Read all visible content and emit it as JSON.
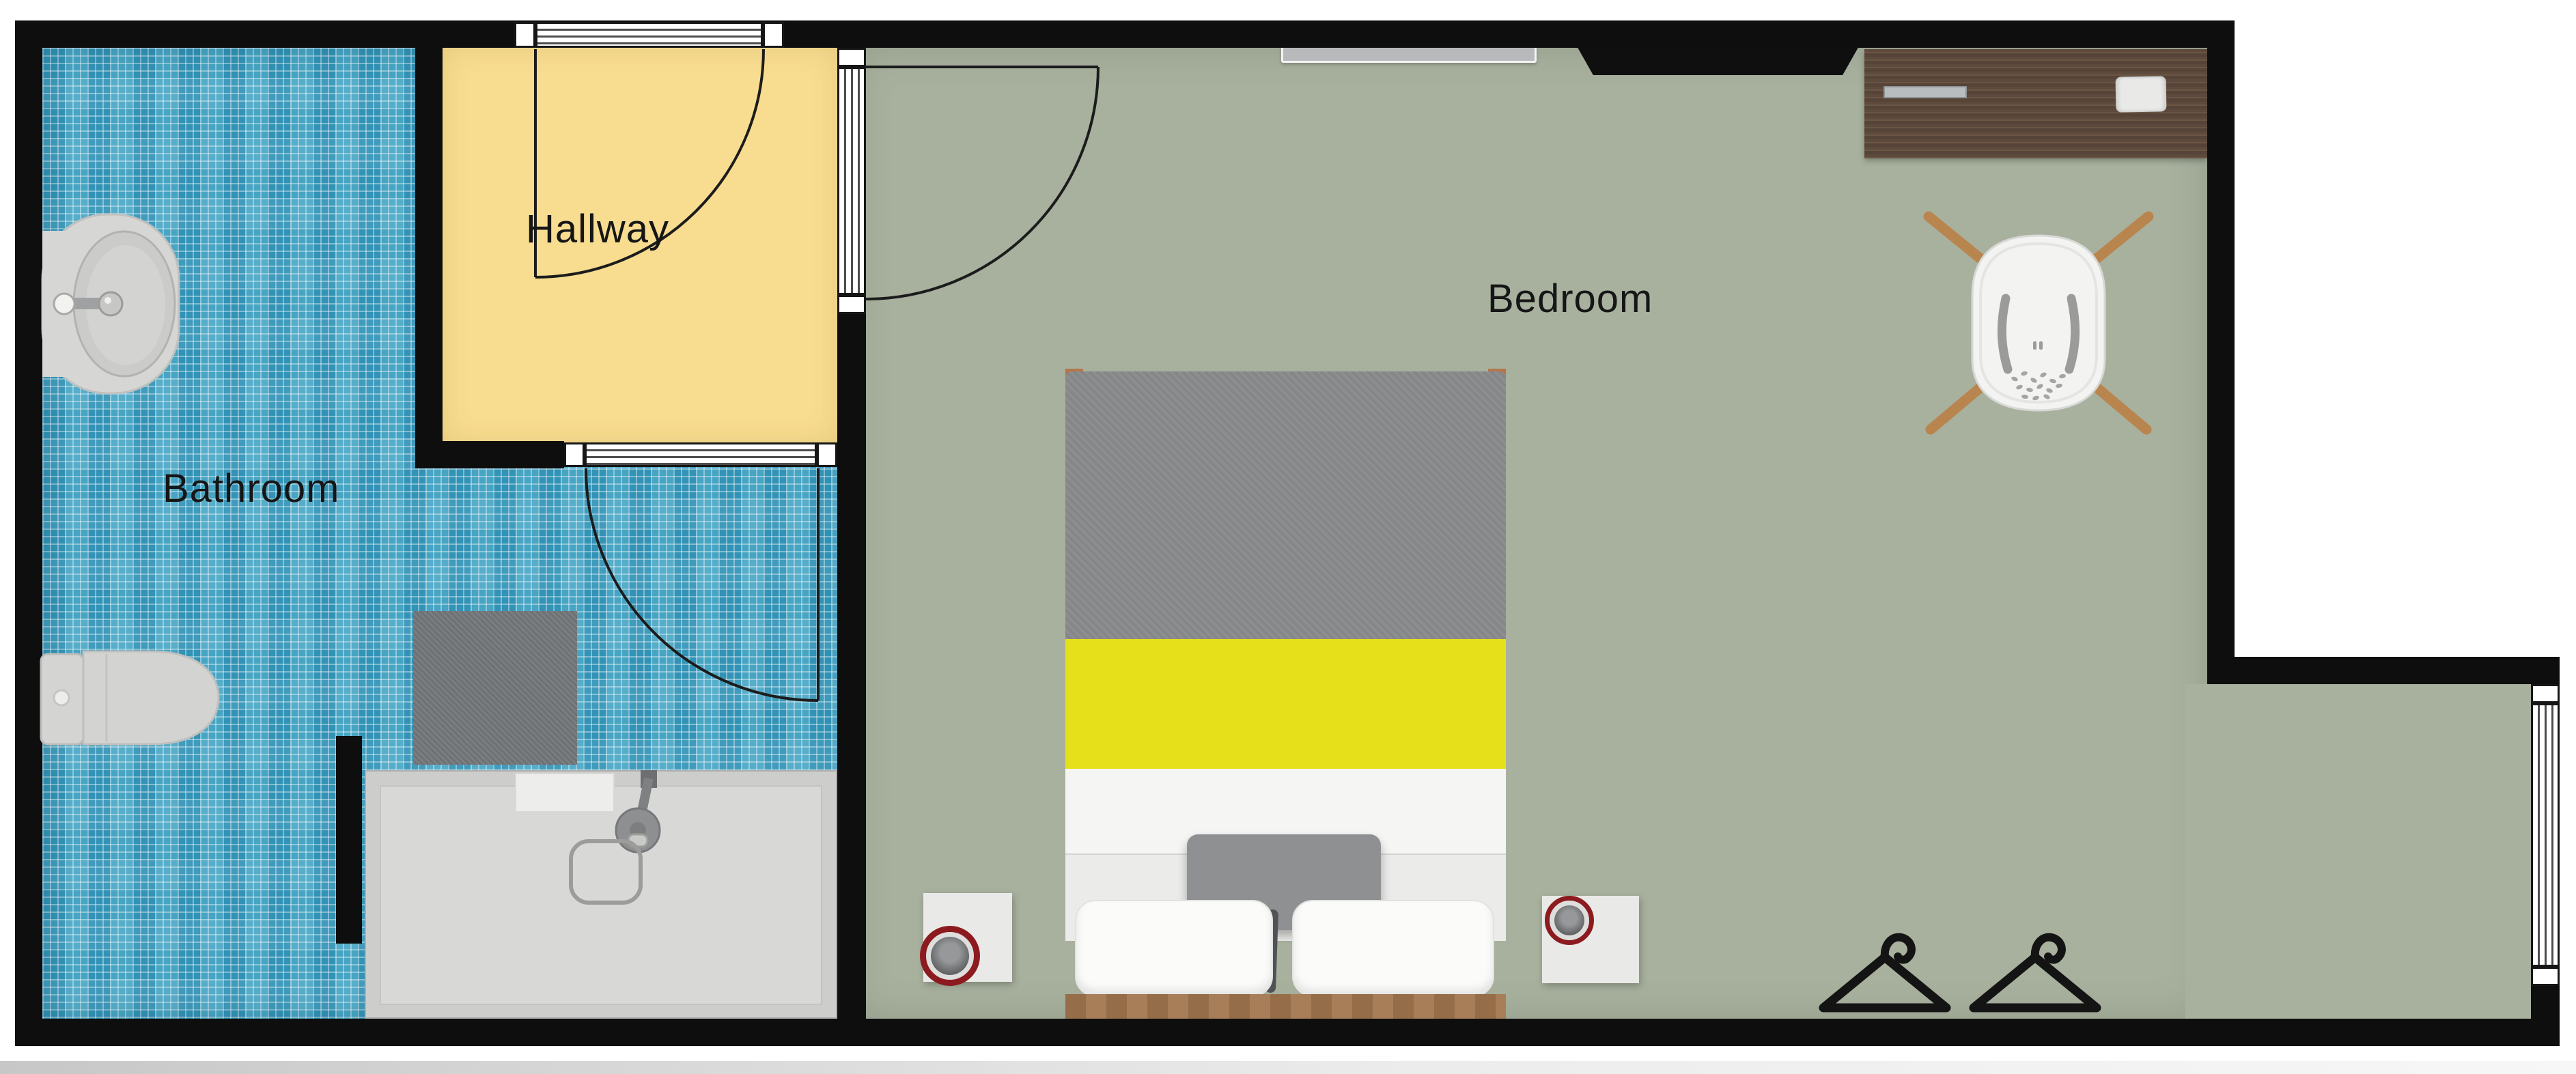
{
  "title": "Apartment floor plan",
  "rooms": [
    {
      "id": "hallway",
      "label": "Hallway"
    },
    {
      "id": "bathroom",
      "label": "Bathroom"
    },
    {
      "id": "bedroom",
      "label": "Bedroom"
    }
  ],
  "palette": {
    "wall_black": "#0e0e0e",
    "bathroom_tile_blue": "#3f9fc1",
    "hallway_floor_yellow": "#f8dc90",
    "bedroom_floor_sage": "#a8b19e",
    "bed_duvet_gray": "#898a8c",
    "bed_accent_yellow": "#e6e01a",
    "bed_sheet_white": "#f5f5f4",
    "headboard_wood": "#a3764f",
    "desk_wood_dark": "#5e4a3c",
    "chair_leg_wood": "#b9854e",
    "speaker_ring_red": "#8c1b20",
    "shower_tray_gray": "#d7d8d6",
    "outside_white": "#ffffff"
  },
  "fixtures": {
    "bathroom": [
      "pedestal-sink",
      "toilet",
      "walk-in-shower",
      "bath-mat"
    ],
    "hallway": [
      "entry-door"
    ],
    "bedroom": [
      "double-bed",
      "nightstand-left",
      "nightstand-right",
      "speaker-left",
      "speaker-right",
      "desk",
      "desk-chair",
      "wall-tv",
      "wall-shelf",
      "clothes-hanger-1",
      "clothes-hanger-2"
    ],
    "doors": [
      "entry-door",
      "bathroom-door",
      "bedroom-door"
    ],
    "windows": [
      "right-wall-window"
    ]
  }
}
